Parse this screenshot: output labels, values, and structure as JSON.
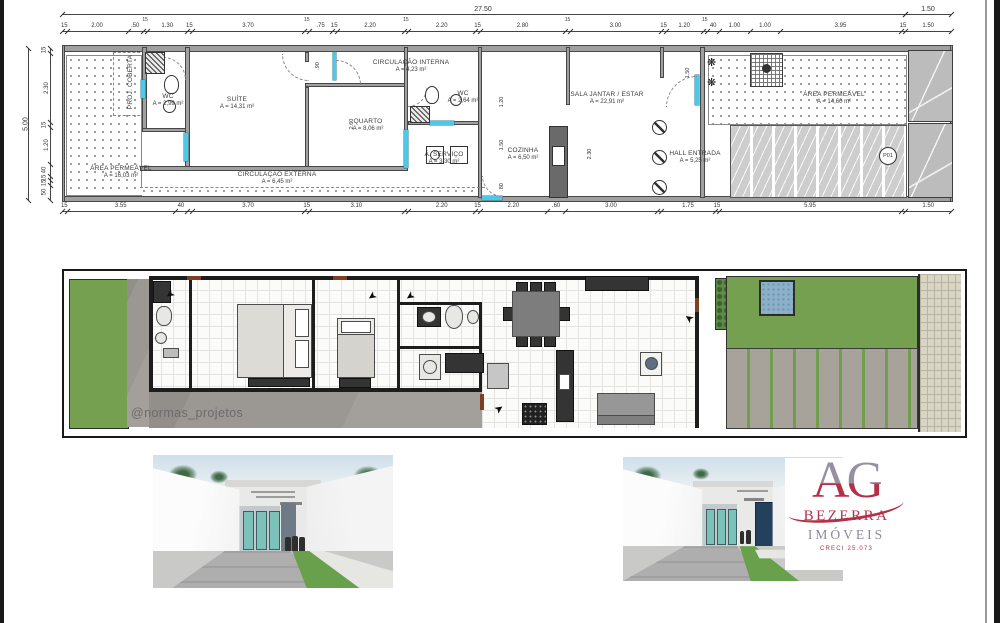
{
  "technical_plan": {
    "overall_width": "27.50",
    "sidewalk_width": "1.50",
    "overall_height": "5.00",
    "dims_top": [
      "15",
      "2.00",
      ".50",
      "15",
      "1.30",
      "15",
      "3.70",
      "15",
      ".75",
      "15",
      "2.20",
      "15",
      "2.20",
      "15",
      "2.80",
      "15",
      "3.00",
      "15",
      "1.20",
      "15",
      "40",
      "1.00",
      "1.00",
      "3.95",
      "15",
      "1.50"
    ],
    "dims_bottom": [
      "15",
      "3.55",
      "40",
      "15",
      "3.70",
      "15",
      "3.10",
      "15",
      "2.20",
      "15",
      "2.20",
      ".60",
      "3.00",
      "15",
      "1.75",
      "15",
      "5.95",
      "15",
      "1.50"
    ],
    "dims_left": [
      "15",
      "2.30",
      "15",
      "1.20",
      "40",
      "15",
      "15",
      "50"
    ],
    "interior_dims": [
      "2.60",
      "2.30",
      "1.20",
      "1.50",
      ".80",
      ".90",
      "1.50"
    ],
    "rooms": [
      {
        "name": "PROJ. COBERTA",
        "area": ""
      },
      {
        "name": "WC",
        "area": "A = 2,99 m²"
      },
      {
        "name": "SUÍTE",
        "area": "A = 14,31 m²"
      },
      {
        "name": "CIRCULAÇÃO INTERNA",
        "area": "A = 4,23 m²"
      },
      {
        "name": "QUARTO",
        "area": "A = 8,06 m²"
      },
      {
        "name": "WC",
        "area": "A = 2,64 m²"
      },
      {
        "name": "Á. SERVIÇO",
        "area": "A = 3,30 m²"
      },
      {
        "name": "COZINHA",
        "area": "A = 6,50 m²"
      },
      {
        "name": "SALA JANTAR / ESTAR",
        "area": "A = 22,91 m²"
      },
      {
        "name": "HALL ENTRADA",
        "area": "A = 5,25 m²"
      },
      {
        "name": "ÁREA PERMEÁVEL",
        "area": "A = 16,03 m²"
      },
      {
        "name": "CIRCULAÇÃO EXTERNA",
        "area": "A = 6,45 m²"
      },
      {
        "name": "ÁREA PERMEÁVEL",
        "area": "A = 14,60 m²"
      }
    ],
    "door_tag": "P01"
  },
  "furnished_plan": {
    "watermark": "@normas_projetos"
  },
  "branding": {
    "monogram": "AG",
    "name": "BEZERRA",
    "type": "IMÓVEIS",
    "creci": "CRECI 25.073"
  },
  "icons": {
    "entry_arrow": "➤",
    "plant": "❋"
  },
  "colors": {
    "accent_cyan": "#4cc9e8",
    "wall_gray": "#a0a0a0",
    "grass_green": "#74a050",
    "concrete_gray": "#9b9792",
    "tile_blue": "#3e7cb0",
    "teal_door": "#7cc2ba",
    "brand_red": "#b43048",
    "brand_gray": "#9790a5"
  }
}
